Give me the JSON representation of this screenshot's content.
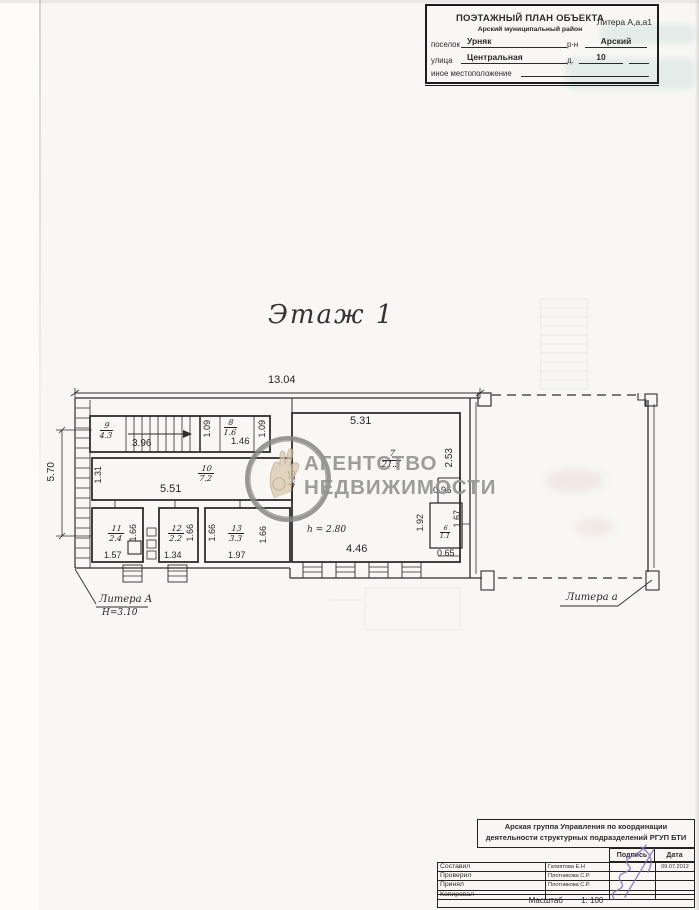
{
  "header": {
    "title": "ПОЭТАЖНЫЙ ПЛАН ОБЪЕКТА",
    "subtitle": "Арский муниципальный район",
    "litera": "Литера А,а,а1",
    "settlement_label": "поселок",
    "settlement_value": "Урняк",
    "district_label": "р-н",
    "district_value": "Арский",
    "street_label": "улица",
    "street_value": "Центральная",
    "house_label": "д.",
    "house_value": "10",
    "other_location_label": "иное местоположение"
  },
  "plan": {
    "floor_title": "Этаж 1",
    "building_label": "Литера А",
    "building_height": "Н=3.10",
    "annex_label": "Литера а",
    "ceiling_height": "h = 2.80",
    "dims": {
      "total_width": "13.04",
      "left_height": "5.70",
      "corridor_left": "1.31",
      "stair_width": "3.96",
      "lobby_width_1": "1.09",
      "room8_width": "1.46",
      "lobby_width_2": "1.09",
      "corridor_width": "5.51",
      "room7_top": "5.31",
      "room7_left": "4.35",
      "room7_right": "2.53",
      "niche_width": "0.95",
      "room7_bottom": "4.46",
      "room6_left": "1.92",
      "room6_right": "1.67",
      "room6_bottom": "0.65",
      "room11_side": "1.66",
      "room11_bottom": "1.57",
      "room12_side": "1.66",
      "room12_bottom": "1.34",
      "room13_left": "1.66",
      "room13_right": "1.66",
      "room13_bottom": "1.97"
    },
    "rooms": {
      "r9": {
        "num": "9",
        "area": "4.3"
      },
      "r8": {
        "num": "8",
        "area": "1.6"
      },
      "r10": {
        "num": "10",
        "area": "7.2"
      },
      "r11": {
        "num": "11",
        "area": "2.4"
      },
      "r12": {
        "num": "12",
        "area": "2.2"
      },
      "r13": {
        "num": "13",
        "area": "3.3"
      },
      "r7": {
        "num": "7",
        "area": "21.5"
      },
      "r6": {
        "num": "6",
        "area": "1.1"
      }
    }
  },
  "watermark": {
    "line1": "АГЕНТСТВО",
    "line2": "НЕДВИЖИМОСТИ"
  },
  "footer": {
    "org_line1": "Арская группа Управления по координации",
    "org_line2": "деятельности структурных подразделений РГУП БТИ",
    "sign_col": "Подпись",
    "date_col": "Дата",
    "rows": [
      {
        "role": "Составил",
        "name": "Гатиятова Е.Н",
        "date": "09.07.2012"
      },
      {
        "role": "Проверил",
        "name": "Плотникова С.Р.",
        "date": ""
      },
      {
        "role": "Принял",
        "name": "Плотникова С.Р.",
        "date": ""
      },
      {
        "role": "Копировал",
        "name": "",
        "date": ""
      }
    ],
    "scale_label": "Масштаб",
    "scale_value": "1: 100"
  },
  "colors": {
    "ink": "#2e2e2e",
    "watermark_gray": "#949490",
    "signature": "#7f72bd"
  }
}
